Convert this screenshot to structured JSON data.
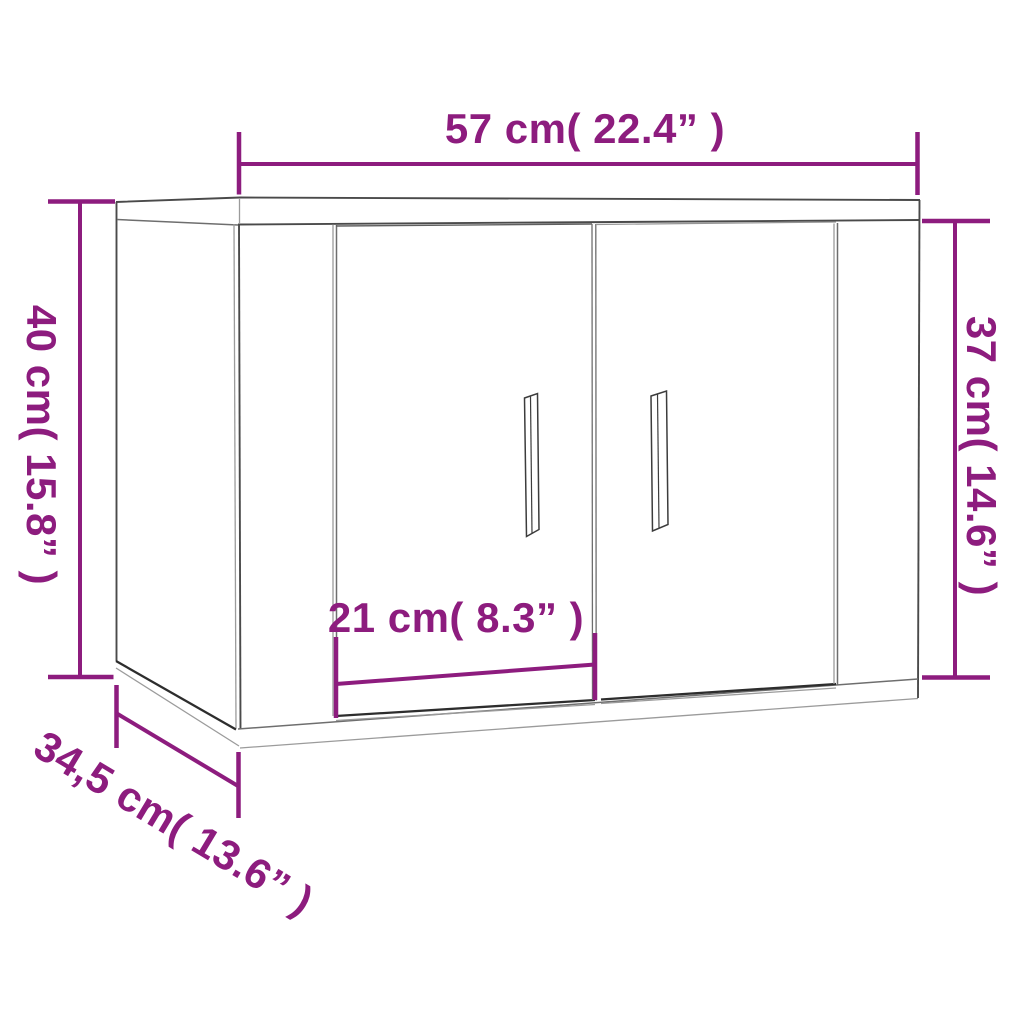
{
  "diagram": {
    "object": "two-door wall cabinet",
    "colors": {
      "dimension_accent": "#8d1c7e",
      "drawing_outline": "#4a4a4a",
      "background": "#ffffff"
    },
    "dimensions": {
      "width": {
        "label": "57 cm( 22.4” )",
        "cm": "57",
        "inches": "22.4"
      },
      "height_left": {
        "label": "40 cm( 15.8” )",
        "cm": "40",
        "inches": "15.8"
      },
      "height_right": {
        "label": "37 cm( 14.6” )",
        "cm": "37",
        "inches": "14.6"
      },
      "door_width": {
        "label": "21 cm( 8.3” )",
        "cm": "21",
        "inches": "8.3"
      },
      "depth": {
        "label": "34,5 cm( 13.6” )",
        "cm": "34,5",
        "inches": "13.6"
      }
    }
  }
}
